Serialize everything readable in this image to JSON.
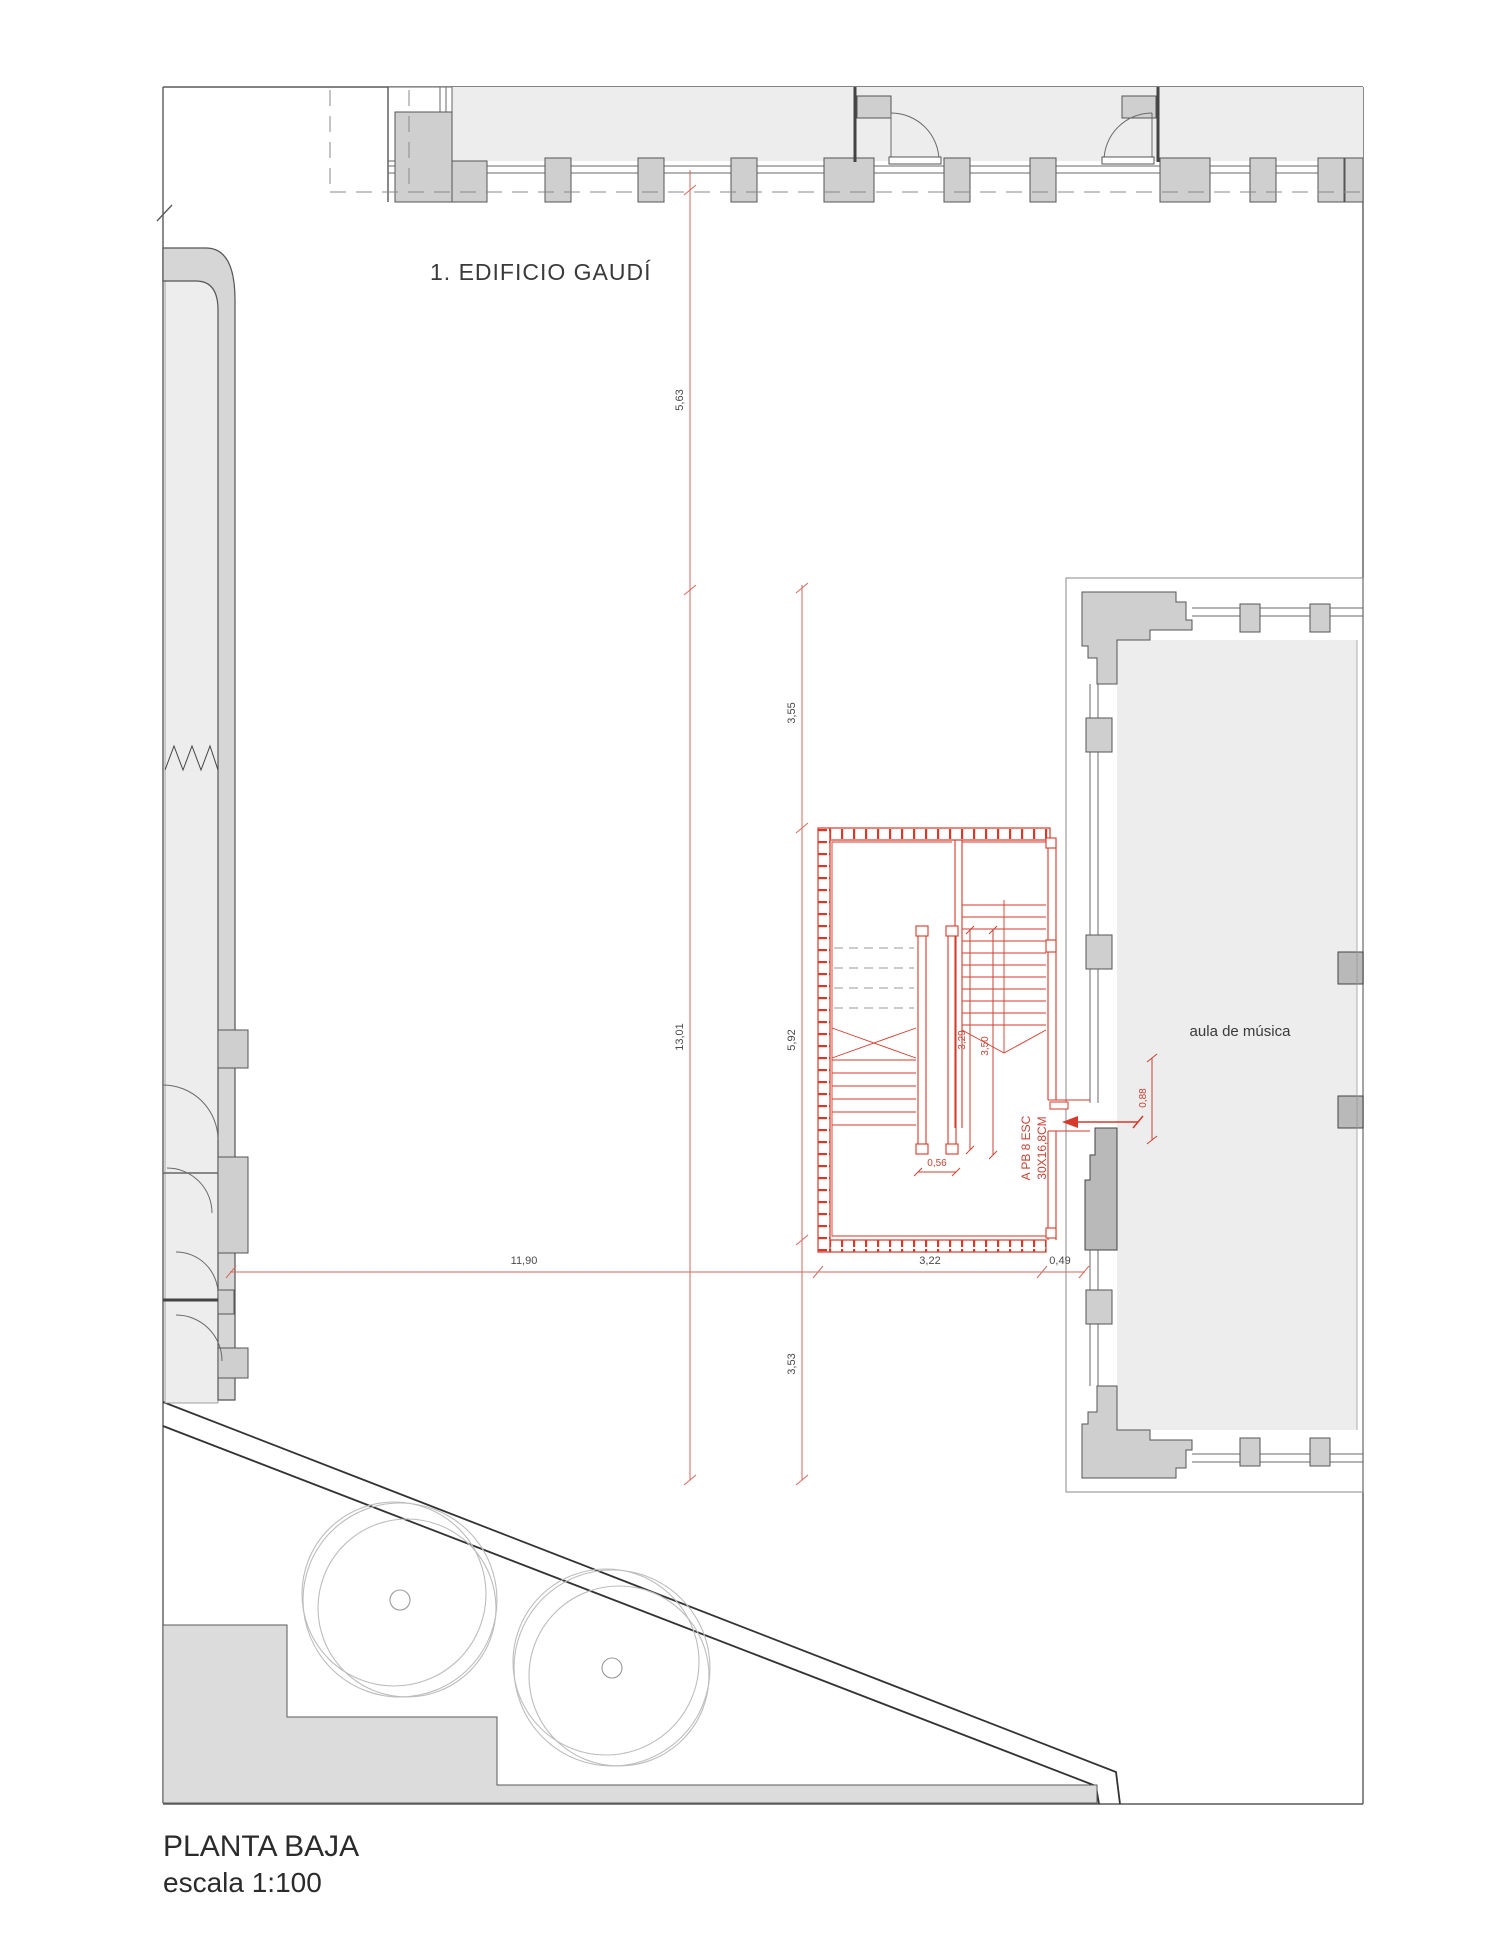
{
  "title_block": {
    "title": "PLANTA BAJA",
    "scale": "escala 1:100"
  },
  "plan": {
    "building_label": "1. EDIFICIO GAUDÍ",
    "room_label": "aula de música",
    "stair_note_line1": "A PB 8 ESC",
    "stair_note_line2": "30X16,8CM"
  },
  "dimensions": {
    "vertical_left": {
      "upper": "5,63",
      "lower": "13,01"
    },
    "vertical_right": {
      "upper": "3,55",
      "middle": "5,92",
      "lower": "3,53"
    },
    "horizontal": {
      "left": "11,90",
      "middle": "3,22",
      "right": "0,49"
    },
    "stair": {
      "core_width": "0,56",
      "flight_a": "3,29",
      "flight_b": "3,50",
      "door": "0,88"
    }
  },
  "colors": {
    "stair_red": "#d63a2a",
    "dimension_red": "#d4685c",
    "wall_gray": "#cfcfcf",
    "floor_gray": "#ededed",
    "line_dark": "#3f3f3f",
    "tree_gray": "#bdbdbd",
    "text_dark": "#2b2b2b"
  }
}
